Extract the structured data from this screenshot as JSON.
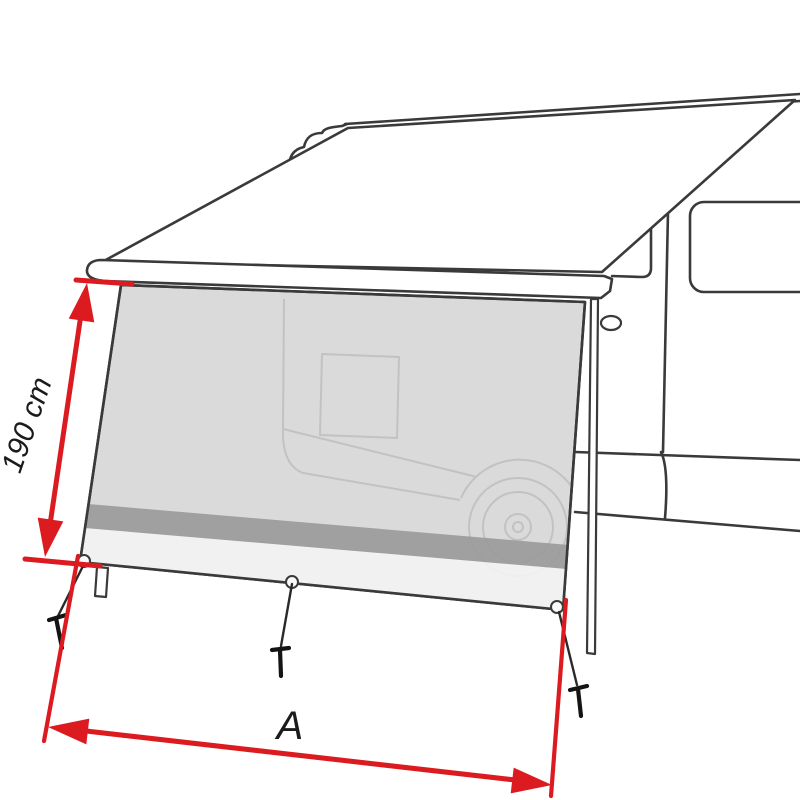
{
  "dimensions": {
    "height_label": "190 cm",
    "width_label": "A"
  },
  "colors": {
    "accent-red": "#dc1b21",
    "line-color": "#3a3a3a",
    "panel-color": "#dadada",
    "band-color": "#9b9b9b",
    "strip-color": "#f3f3f3",
    "ghost-color": "#c2c2c2",
    "label-color": "#1b1b1b",
    "background": "#ffffff"
  }
}
